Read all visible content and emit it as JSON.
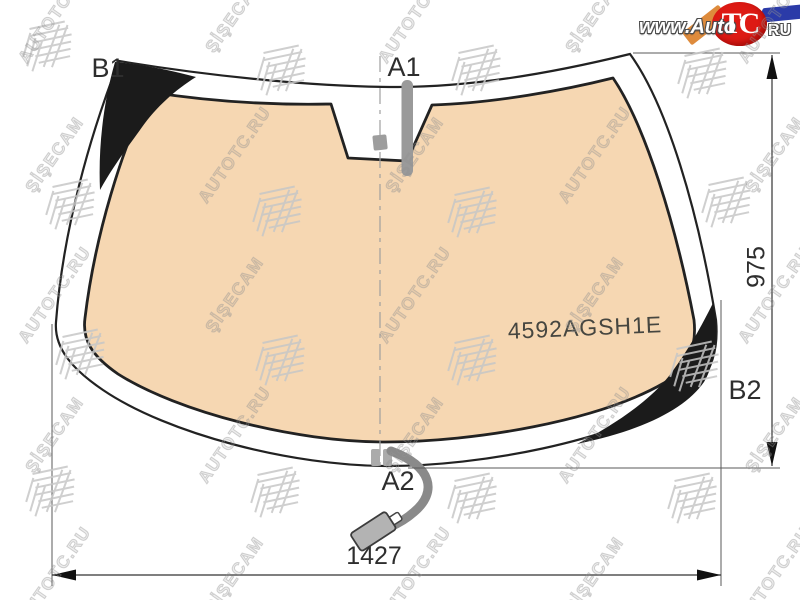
{
  "logo": {
    "prefix": "www.Auto",
    "circle": "TC",
    "suffix": "RU"
  },
  "labels": {
    "a1": "A1",
    "a2": "A2",
    "b1": "B1",
    "b2": "B2"
  },
  "dimensions": {
    "width": "1427",
    "height": "975"
  },
  "part_number": "4592AGSH1E",
  "watermarks": {
    "brand1": "AUTOTC.RU",
    "brand2": "ŞİŞECAM"
  },
  "colors": {
    "glass": "#F6D7B2",
    "trim": "#1b1b1b",
    "outline": "#222222",
    "hardware_gray": "#9a9a9a",
    "logo_red": "#DD1A14",
    "logo_orange": "#DE8B3C",
    "logo_blue": "#2B3BA8"
  }
}
